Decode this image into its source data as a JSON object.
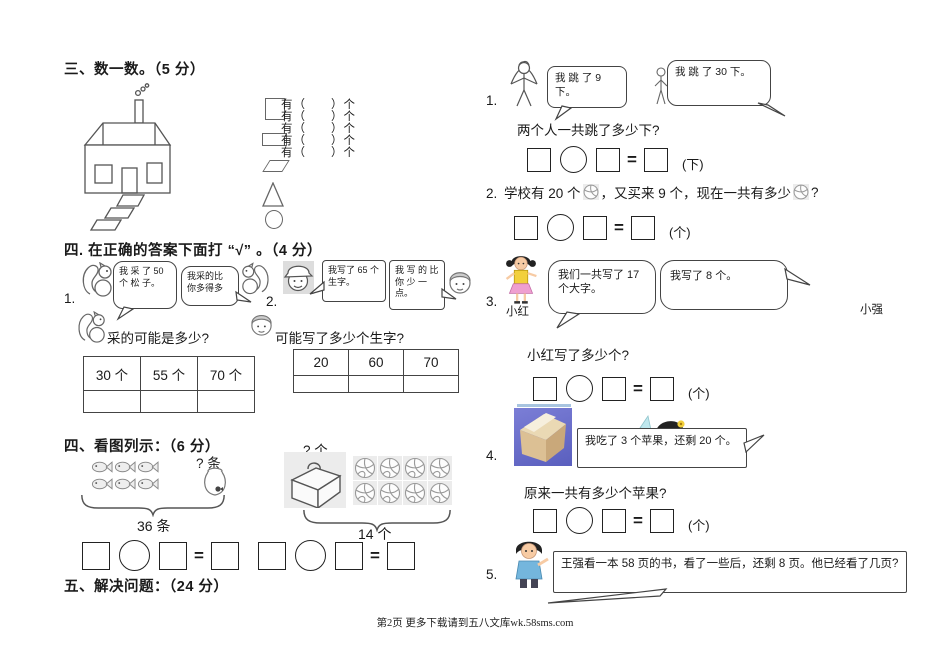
{
  "symbols": {
    "equals": "="
  },
  "footer": {
    "text": "第2页 更多下载请到五八文库wk.58sms.com"
  },
  "sec3": {
    "heading": "三、数一数。（5 分）",
    "count_lines": [
      "有（　　）个",
      "有（　　）个",
      "有（　　）个",
      "有（　　）个",
      "有（　　）个"
    ]
  },
  "sec4a": {
    "heading": "四. 在正确的答案下面打 “√” 。（4 分）",
    "p1": {
      "number": "1.",
      "bubble1": "我 采 了 50 个 松 子。",
      "bubble2": "我采的比 你多得多",
      "question": "采的可能是多少?",
      "options": [
        "30 个",
        "55 个",
        "70 个"
      ]
    },
    "p2": {
      "number": "2.",
      "bubble1": "我写了 65 个生字。",
      "bubble2": "我 写 的 比 你 少 一 点。",
      "question": "可能写了多少个生字?",
      "options": [
        "20",
        "60",
        "70"
      ]
    }
  },
  "sec4b": {
    "heading": "四、看图列示：（6 分）",
    "fish": {
      "unknown": "? 条",
      "total": "36 条"
    },
    "balls": {
      "unknown": "? 个",
      "total": "14 个"
    }
  },
  "sec5": {
    "heading": "五、解决问题：（24 分）",
    "p1": {
      "number": "1.",
      "bubble1": "我 跳 了 9 下。",
      "bubble2": "我 跳 了 30 下。",
      "question": "两个人一共跳了多少下?",
      "unit": "(下)"
    },
    "p2": {
      "number": "2.",
      "text1": "学校有 20 个",
      "text2": "，又买来 9 个，现在一共有多少",
      "text3": "?",
      "unit": "(个)"
    },
    "p3": {
      "number": "3.",
      "name_left": "小红",
      "name_right": "小强",
      "bubble1": "我们一共写了 17 个大字。",
      "bubble2": "我写了 8 个。",
      "question": "小红写了多少个?",
      "unit": "(个)"
    },
    "p4": {
      "number": "4.",
      "bubble": "我吃了 3 个苹果，还剩 20 个。",
      "question": "原来一共有多少个苹果?",
      "unit": "(个)"
    },
    "p5": {
      "number": "5.",
      "bubble": "王强看一本 58 页的书，看了一些后，还剩 8 页。他已经看了几页?"
    }
  }
}
